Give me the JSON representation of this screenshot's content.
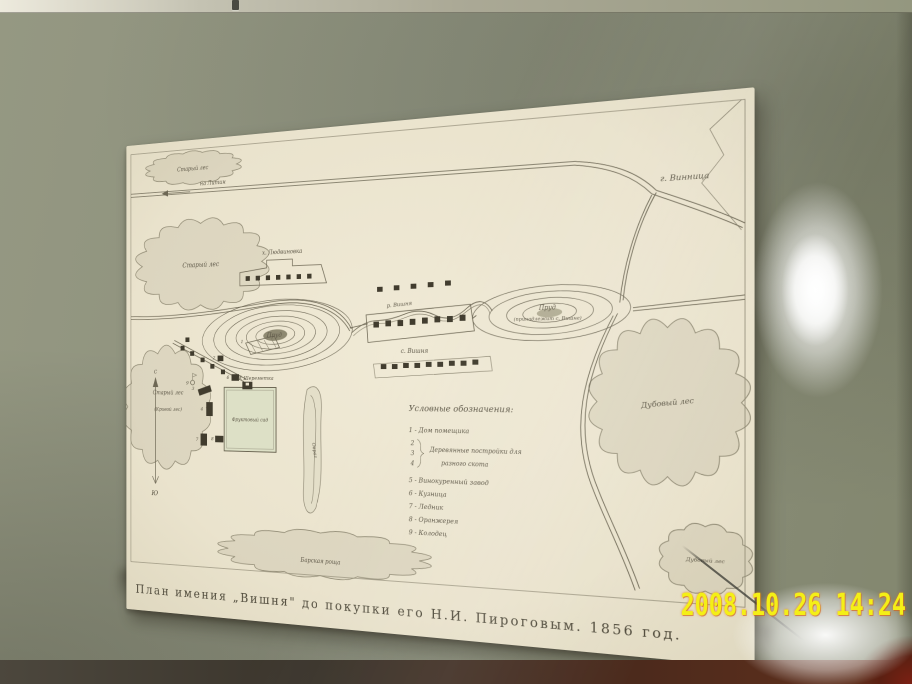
{
  "photo": {
    "timestamp": "2008.10.26 14:24"
  },
  "colors": {
    "wall": "#8c907d",
    "paper": "#ece5d0",
    "ink": "#5d5747",
    "timestamp_yellow": "#f4ef16",
    "frame_corner_red": "#5b2012"
  },
  "map": {
    "caption": "План имения „Вишня\" до покупки его Н.И. Пироговым. 1856 год.",
    "labels": {
      "old_forest_top": "Старый лес",
      "litin": "на Литин",
      "vinnitsa": "г. Винница",
      "old_forest_left": "Старый лес",
      "old_forest_lower": "Старый лес",
      "old_forest_lower_sub": "(Кривой лес)",
      "ludvinovka": "х. Людвиновка",
      "pond_left": "Пруд",
      "sheremetka": "с. Шереметка",
      "river": "р. Вишня",
      "village": "с. Вишня",
      "pond_right": "Пруд",
      "pond_right_sub": "(принадлежит с. Вишне)",
      "oak_forest": "Дубовый лес",
      "oak_forest_small": "Дубовый лес",
      "grove": "Барская роща",
      "orchard": "Фруктовый сад",
      "ravine": "Овраг",
      "north": "С",
      "south": "Ю"
    },
    "legend": {
      "title": "Условные обозначения:",
      "item1": "1 - Дом помещика",
      "num2": "2",
      "num3": "3",
      "num4": "4",
      "group_line1": "Деревянные постройки для",
      "group_line2": "разного скота",
      "item5": "5 - Винокуренный завод",
      "item6": "6 - Кузница",
      "item7": "7 - Ледник",
      "item8": "8 - Оранжерея",
      "item9": "9 - Колодец"
    },
    "building_numbers": [
      "1",
      "2",
      "3",
      "4",
      "5",
      "6",
      "7",
      "8",
      "9"
    ]
  }
}
